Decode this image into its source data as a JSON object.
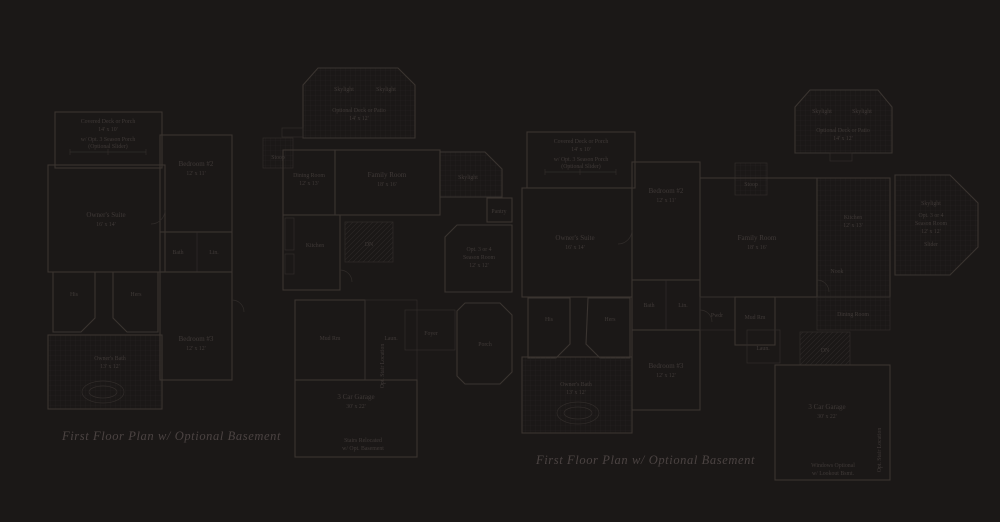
{
  "colors": {
    "background": "#1b1817",
    "wall_line": "#3a3430",
    "thin_line": "#312c2a",
    "hatch_line": "#252121",
    "label_text": "#403a38",
    "caption_text": "#4b4342"
  },
  "captions": {
    "left": "First Floor Plan w/ Optional Basement",
    "right": "First Floor Plan  w/ Optional Basement"
  },
  "labels": {
    "porch1": "Covered Deck or Porch",
    "porch2": "14' x 10'",
    "porch3": "w/ Opt. 3 Season Porch",
    "porch4": "(Optional Slider)",
    "skylight": "Skylight",
    "deck_patio": "Optional Deck or Patio",
    "deck_patio_dim": "14' x 12'",
    "season1": "Opt. 3 or 4",
    "season2": "Season Room",
    "season3": "12' x 12'",
    "season4": "Slider",
    "owners_suite": "Owner's Suite",
    "owners_suite_dim": "16' x 14'",
    "owners_bath": "Owner's Bath",
    "owners_bath_dim": "13' x 12'",
    "bedroom2": "Bedroom #2",
    "bedroom2_dim": "12' x 11'",
    "bedroom3": "Bedroom #3",
    "bedroom3_dim": "12' x 12'",
    "family_room": "Family Room",
    "family_room_dim": "18' x 16'",
    "dining": "Dining Room",
    "dining_dim": "12' x 13'",
    "kitchen": "Kitchen",
    "kitchen_dim": "12' x 13'",
    "nook": "Nook",
    "pantry": "Pantry",
    "foyer": "Foyer",
    "porch": "Porch",
    "stoop": "Stoop",
    "his": "His",
    "hers": "Hers",
    "bath": "Bath",
    "linen": "Lin.",
    "laundry": "Laun.",
    "powder": "Pwdr",
    "mud_room": "Mud Rm",
    "garage": "3 Car Garage",
    "garage_dim": "30' x 22'",
    "dn": "DN",
    "stair_note": "Opt. Stair Location",
    "garage_note1": "Stairs Relocated",
    "garage_note2": "w/ Opt. Basement",
    "bsmt_note1": "Windows Optional",
    "bsmt_note2": "w/ Lookout Bsmt."
  }
}
